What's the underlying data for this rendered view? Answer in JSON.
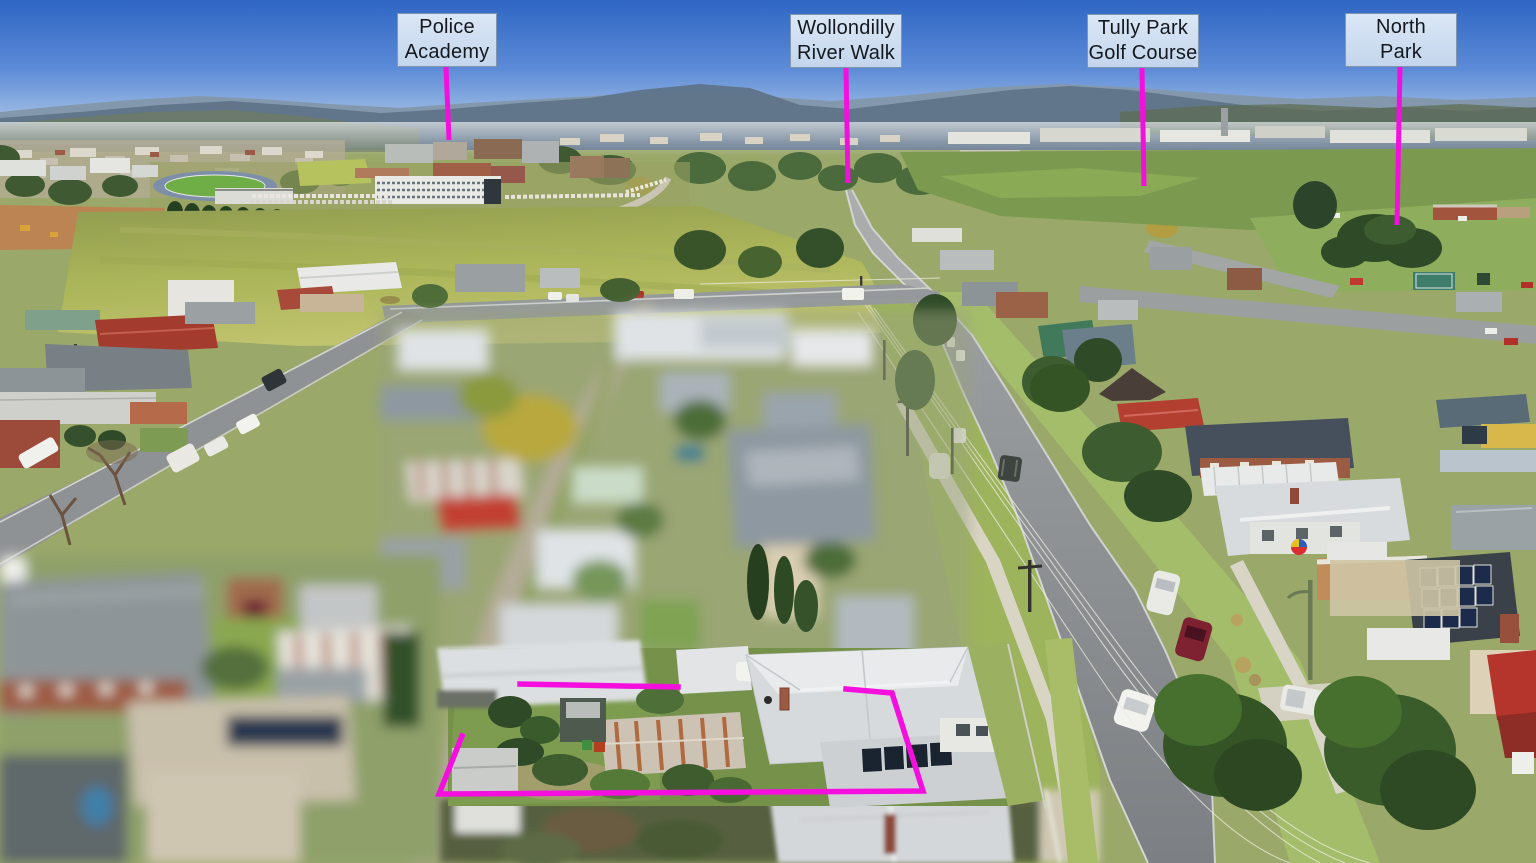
{
  "annotations": {
    "style": {
      "accent_color": "#f40fdf",
      "label_background_top": "#dae7f6",
      "label_background_bottom": "#c4d6ec",
      "label_border": "#8096ae",
      "label_text_color": "#14181e",
      "pointer_width": 5,
      "boundary_width": 5.5
    },
    "labels": [
      {
        "id": "police-academy",
        "line1": "Police",
        "line2": "Academy",
        "box": {
          "x": 397,
          "y": 13,
          "w": 100,
          "h": 54
        },
        "pointer": {
          "x1": 446,
          "y1": 67,
          "x2": 449,
          "y2": 140
        }
      },
      {
        "id": "wollondilly-river-walk",
        "line1": "Wollondilly",
        "line2": "River Walk",
        "box": {
          "x": 790,
          "y": 14,
          "w": 112,
          "h": 54
        },
        "pointer": {
          "x1": 846,
          "y1": 68,
          "x2": 848,
          "y2": 183
        }
      },
      {
        "id": "tully-park-golf-course",
        "line1": "Tully Park",
        "line2": "Golf Course",
        "box": {
          "x": 1087,
          "y": 14,
          "w": 112,
          "h": 54
        },
        "pointer": {
          "x1": 1142,
          "y1": 68,
          "x2": 1144,
          "y2": 186
        }
      },
      {
        "id": "north-park",
        "line1": "North",
        "line2": "Park",
        "box": {
          "x": 1345,
          "y": 13,
          "w": 112,
          "h": 54
        },
        "pointer": {
          "x1": 1400,
          "y1": 67,
          "x2": 1397,
          "y2": 225
        }
      }
    ],
    "property_boundary": {
      "segments": [
        "520,684 678,687",
        "846,689 892,693 923,791 439,794 462,736"
      ]
    }
  }
}
